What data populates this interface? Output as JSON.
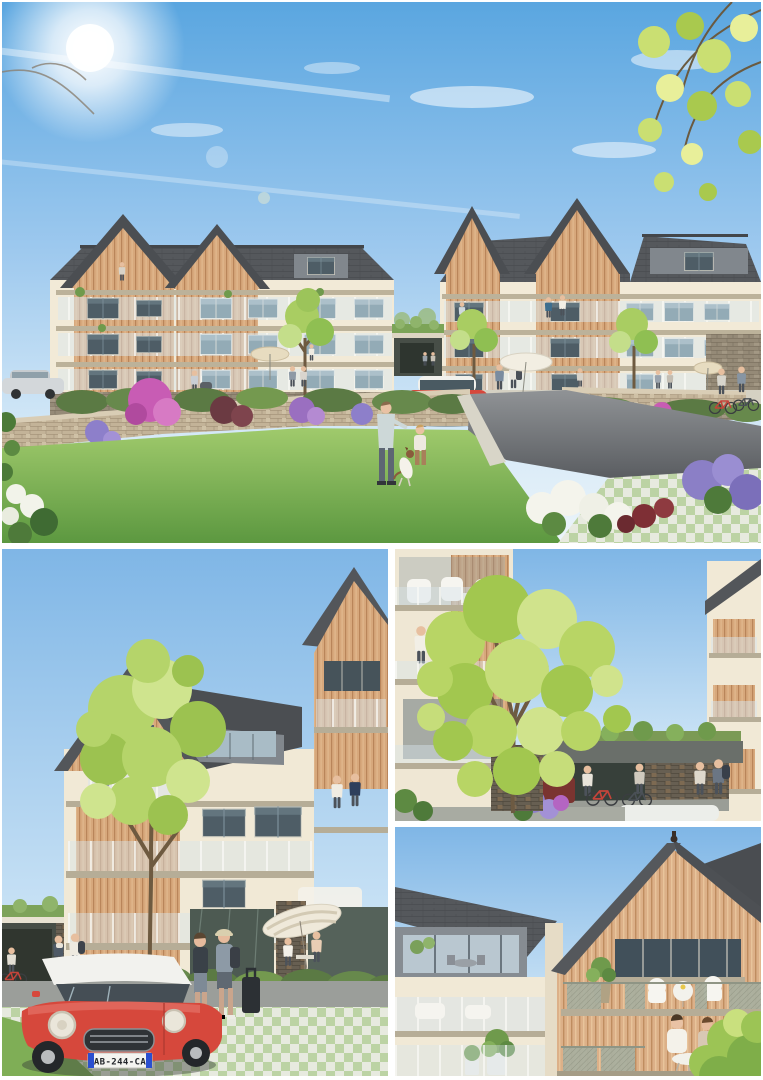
{
  "meta": {
    "kind": "architectural-rendering-photo-collage",
    "panel_count": 4
  },
  "panels": {
    "overview": {
      "alt": "Street view of two three-storey gabled residences with timber cladding and balconies around a lawn, stone garden wall, driveway, residents, and a red mini"
    },
    "entrance": {
      "alt": "Close view of residence entrance court with parked red mini, arriving residents with luggage, terrace parasol and young tree"
    },
    "courtyard": {
      "alt": "Courtyard between residences with large tree, planted bike shelter, cyclists and balcony residents"
    },
    "balconies": {
      "alt": "Close-up of timber gable balconies with wicker furniture and residents dining"
    }
  },
  "vehicle": {
    "license_plate": "AB-244-CA",
    "body_color": "#d6483c",
    "roof_color": "#f2f2ee"
  },
  "palette": {
    "sky_top": "#5aa6e0",
    "sky_horizon": "#ecf4fa",
    "roof_slate": "#55585c",
    "zinc": "#81878d",
    "timber": "#d7a87c",
    "wall_cream": "#f1e9d6",
    "stone_wall": "#c3b398",
    "stone_base": "#958a77",
    "lawn": "#6fae4e",
    "hedge": "#5b7a44",
    "asphalt": "#77797b",
    "paver_green": "#bcd3a4",
    "blossom_pink": "#c85cb4",
    "hydrangea_purple": "#8d7fca",
    "flower_white": "#f4f4ec"
  }
}
